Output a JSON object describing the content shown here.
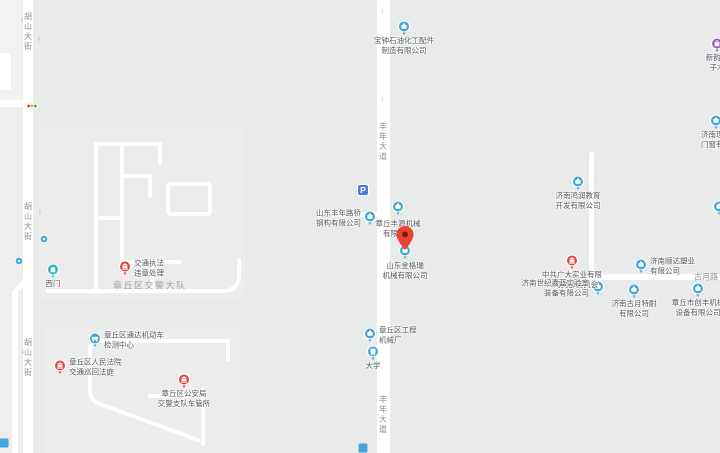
{
  "map": {
    "colors": {
      "background": "#e9eaea",
      "road": "#ffffff",
      "poi_blue": "#41a6d9",
      "poi_red": "#e2483d",
      "poi_teal": "#2bb6c9",
      "poi_purple": "#a05bc5",
      "parking_blue": "#4c7ce0",
      "pin_red": "#ea4335",
      "pin_dot": "#7e180d",
      "poi_label_color": "#54575c",
      "road_label_color": "#8f8f8f"
    },
    "road_labels": [
      {
        "id": "hushan-street-top",
        "text": "胡山大街",
        "x": 28,
        "y": 12,
        "orientation": "vertical",
        "style": "normal"
      },
      {
        "id": "hushan-street-mid",
        "text": "胡山大街",
        "x": 28,
        "y": 202,
        "orientation": "vertical",
        "style": "normal"
      },
      {
        "id": "hushan-street-bottom",
        "text": "胡山大街",
        "x": 28,
        "y": 338,
        "orientation": "vertical",
        "style": "normal"
      },
      {
        "id": "fengnian-avenue-top",
        "text": "丰年大道",
        "x": 383,
        "y": 122,
        "orientation": "vertical",
        "style": "normal"
      },
      {
        "id": "fengnian-avenue-bottom",
        "text": "丰年大道",
        "x": 383,
        "y": 395,
        "orientation": "vertical",
        "style": "normal"
      },
      {
        "id": "guyue-road",
        "text": "古月路",
        "x": 694,
        "y": 277,
        "orientation": "horizontal",
        "style": "normal"
      },
      {
        "id": "jiaojing-compound",
        "text": "章丘区交警大队",
        "x": 113,
        "y": 286,
        "orientation": "horizontal",
        "style": "area"
      }
    ],
    "arrows": [
      {
        "x": 22,
        "y": 20,
        "glyph": "↓"
      },
      {
        "x": 39,
        "y": 40,
        "glyph": "↑"
      },
      {
        "x": 40,
        "y": 212,
        "glyph": "↑"
      },
      {
        "x": 23,
        "y": 352,
        "glyph": "↓"
      },
      {
        "x": 382,
        "y": 11,
        "glyph": "↓"
      },
      {
        "x": 382,
        "y": 99,
        "glyph": "↓"
      },
      {
        "x": 381,
        "y": 428,
        "glyph": "↑"
      }
    ],
    "pois": [
      {
        "name": "baozhong-petro-parts",
        "type": "business",
        "x": 404,
        "y": 28,
        "label_lines": [
          "宝钟石油化工配件",
          "制造有限公司"
        ],
        "label_pos": "below"
      },
      {
        "name": "xinyun-edge",
        "type": "shop",
        "x": 717,
        "y": 45,
        "label_lines": [
          "新韵电",
          "子木"
        ],
        "label_pos": "below"
      },
      {
        "name": "lixiang-doors",
        "type": "business",
        "x": 716,
        "y": 122,
        "label_lines": [
          "济南理想",
          "门窗有限"
        ],
        "label_pos": "below"
      },
      {
        "name": "hongrun-education",
        "type": "business",
        "x": 578,
        "y": 183,
        "label_lines": [
          "济南鸿润教育",
          "开发有限公司"
        ],
        "label_pos": "below"
      },
      {
        "name": "parking",
        "type": "parking",
        "x": 363,
        "y": 190,
        "label_lines": [],
        "label_pos": "none"
      },
      {
        "name": "fengnian-steel",
        "type": "business",
        "x": 370,
        "y": 218,
        "label_lines": [
          "山东丰年路桥",
          "钢构有限公司"
        ],
        "label_pos": "left"
      },
      {
        "name": "fengyuan-machinery",
        "type": "business",
        "x": 398,
        "y": 208,
        "label_lines": [
          "章丘丰源机械",
          "有限公司"
        ],
        "label_pos": "below",
        "label_dy": 11
      },
      {
        "name": "jingerui-machinery",
        "type": "business",
        "x": 405,
        "y": 252,
        "label_lines": [
          "山东金格瑞",
          "机械有限公司"
        ],
        "label_pos": "below",
        "label_dy": 9
      },
      {
        "name": "destination-pin",
        "type": "pin",
        "x": 405,
        "y": 250,
        "label_lines": [],
        "label_pos": "none"
      },
      {
        "name": "zhonggong-party-branch",
        "type": "gov",
        "x": 572,
        "y": 262,
        "label_lines": [
          "中共广大实业有限",
          "公司支部委员会"
        ],
        "label_pos": "below"
      },
      {
        "name": "shunda-plastics",
        "type": "business",
        "x": 641,
        "y": 266,
        "label_lines": [
          "济南顺达塑业",
          "有限公司"
        ],
        "label_pos": "right"
      },
      {
        "name": "jialan-lab-equipment",
        "type": "business",
        "x": 598,
        "y": 288,
        "label_lines": [
          "济南世纪嘉蓝实验室",
          "装备有限公司"
        ],
        "label_pos": "left"
      },
      {
        "name": "guyue-tenai",
        "type": "business",
        "x": 634,
        "y": 291,
        "label_lines": [
          "济南古月特耐",
          "有限公司"
        ],
        "label_pos": "below"
      },
      {
        "name": "chuangfeng-machinery",
        "type": "business",
        "x": 698,
        "y": 290,
        "label_lines": [
          "章丘市创丰机械",
          "设备有限公司"
        ],
        "label_pos": "below"
      },
      {
        "name": "edge-poi",
        "type": "business",
        "x": 719,
        "y": 208,
        "label_lines": [],
        "label_pos": "none"
      },
      {
        "name": "west-gate",
        "type": "gate",
        "x": 53,
        "y": 271,
        "label_lines": [
          "西门"
        ],
        "label_pos": "below"
      },
      {
        "name": "small-dot-1",
        "type": "dot",
        "x": 44,
        "y": 239,
        "label_lines": [],
        "label_pos": "none"
      },
      {
        "name": "small-dot-2",
        "type": "dot",
        "x": 19,
        "y": 261,
        "label_lines": [],
        "label_pos": "none"
      },
      {
        "name": "traffic-enforcement",
        "type": "gov",
        "x": 125,
        "y": 268,
        "label_lines": [
          "交通执法",
          "违章处理"
        ],
        "label_pos": "right"
      },
      {
        "name": "tongda-vehicle-inspection",
        "type": "car",
        "x": 95,
        "y": 340,
        "label_lines": [
          "章丘区通达机动车",
          "检测中心"
        ],
        "label_pos": "right"
      },
      {
        "name": "court-traffic-circuit",
        "type": "gov",
        "x": 60,
        "y": 367,
        "label_lines": [
          "章丘区人民法院",
          "交通巡回法庭"
        ],
        "label_pos": "right"
      },
      {
        "name": "vehicle-admin-office",
        "type": "gov",
        "x": 184,
        "y": 381,
        "label_lines": [
          "章丘区公安局",
          "交警支队车管所"
        ],
        "label_pos": "below"
      },
      {
        "name": "gongcheng-machinery-factory",
        "type": "business",
        "x": 370,
        "y": 335,
        "label_lines": [
          "章丘区工程",
          "机械厂"
        ],
        "label_pos": "right"
      },
      {
        "name": "daxue-bus-stop",
        "type": "bus",
        "x": 373,
        "y": 353,
        "label_lines": [
          "大学"
        ],
        "label_pos": "below"
      },
      {
        "name": "traffic-light",
        "type": "traffic-light",
        "x": 32,
        "y": 106,
        "label_lines": [],
        "label_pos": "none"
      },
      {
        "name": "partial-bottom-center",
        "type": "partial",
        "x": 363,
        "y": 448,
        "label_lines": [],
        "label_pos": "none"
      },
      {
        "name": "partial-bottom-left",
        "type": "partial",
        "x": 4,
        "y": 443,
        "label_lines": [],
        "label_pos": "none"
      }
    ]
  }
}
